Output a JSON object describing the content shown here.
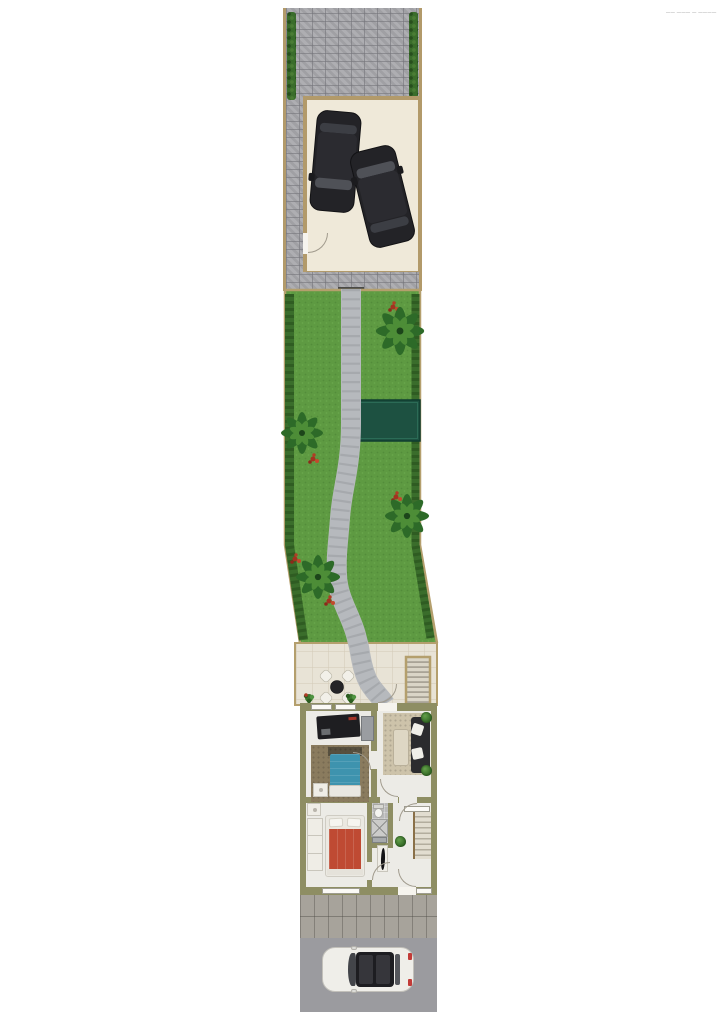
{
  "page": {
    "background_color": "#ffffff",
    "watermark_text": "—— ——— — ————"
  },
  "plan": {
    "type": "residential site and floor plan, top-down view",
    "sections": [
      "driveway",
      "garage",
      "garden",
      "patio",
      "house",
      "sidewalk",
      "street"
    ],
    "driveway": {
      "surface": "gray paver bricks",
      "hedges": 2
    },
    "garage": {
      "floor_color": "#efe9d9",
      "door_count": 1,
      "cars": [
        {
          "color": "black",
          "orientation": "front-down"
        },
        {
          "color": "black",
          "orientation": "front-up-angled"
        }
      ]
    },
    "garden": {
      "grass_color": "#5e9a42",
      "trees": 4,
      "flower_bushes": 6,
      "hedge_color": "#3a6d2b",
      "shed_color": "#1d5141",
      "path": "curved gray paver walkway"
    },
    "patio": {
      "tile_color": "#e8e3d6",
      "table_seats": 4,
      "table_color": "#242427",
      "plants": 2,
      "exterior_stairs": 1
    },
    "house": {
      "wall_color": "#8e8e63",
      "floor_color": "#ecebe6",
      "rooms": [
        "bedroom-1 with kitchenette",
        "living-room",
        "bedroom-2",
        "shower-room",
        "hallway"
      ],
      "furniture": {
        "kitchen_counter_color": "#1e1e21",
        "bed_1_color": "#3e93ae",
        "bed_2_color": "#bf4a33",
        "living_sofa_color": "#2b2b2e",
        "living_rug_color": "#cdc3aa",
        "bedroom_rug_color": "#8a7b5e"
      },
      "interior_stairs": 1,
      "windows": 4,
      "door_arcs": 7
    },
    "street": {
      "surface_color": "#9b9b9f",
      "sidewalk": "flagstone",
      "cars": [
        {
          "color": "white",
          "orientation": "front-left"
        }
      ]
    },
    "colors": {
      "paving": "#a9a9ad",
      "exterior_wall": "#b29a6a",
      "grass": "#5e9a42",
      "shed": "#1d5141",
      "patio_tile": "#e8e3d6",
      "house_wall": "#8e8e63",
      "street": "#9b9b9f"
    }
  }
}
